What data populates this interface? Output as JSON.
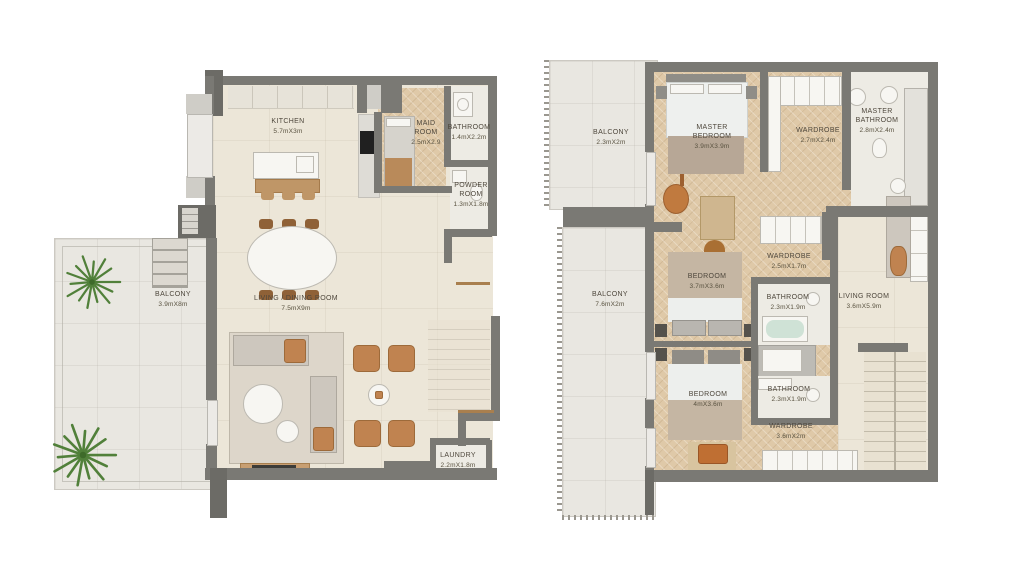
{
  "lower_plan": {
    "rooms": {
      "kitchen": {
        "name": "KITCHEN",
        "dims": "5.7mX3m"
      },
      "maid_room": {
        "name": "MAID ROOM",
        "dims": "2.5mX2.9"
      },
      "bathroom": {
        "name": "BATHROOM",
        "dims": "1.4mX2.2m"
      },
      "powder_room": {
        "name": "POWDER ROOM",
        "dims": "1.3mX1.8m"
      },
      "balcony": {
        "name": "BALCONY",
        "dims": "3.9mX8m"
      },
      "living_dining_room": {
        "name": "LIVING / DINING ROOM",
        "dims": "7.5mX9m"
      },
      "laundry": {
        "name": "LAUNDRY",
        "dims": "2.2mX1.8m"
      }
    }
  },
  "upper_plan": {
    "rooms": {
      "balcony_top": {
        "name": "BALCONY",
        "dims": "2.3mX2m"
      },
      "master_bedroom": {
        "name": "MASTER BEDROOM",
        "dims": "3.9mX3.9m"
      },
      "wardrobe_master": {
        "name": "WARDROBE",
        "dims": "2.7mX2.4m"
      },
      "master_bathroom": {
        "name": "MASTER BATHROOM",
        "dims": "2.8mX2.4m"
      },
      "balcony_side": {
        "name": "BALCONY",
        "dims": "7.6mX2m"
      },
      "bedroom_1": {
        "name": "BEDROOM",
        "dims": "3.7mX3.6m"
      },
      "wardrobe_mid": {
        "name": "WARDROBE",
        "dims": "2.5mX1.7m"
      },
      "bathroom_1": {
        "name": "BATHROOM",
        "dims": "2.3mX1.9m"
      },
      "living_room": {
        "name": "LIVING ROOM",
        "dims": "3.6mX5.9m"
      },
      "bedroom_2": {
        "name": "BEDROOM",
        "dims": "4mX3.6m"
      },
      "bathroom_2": {
        "name": "BATHROOM",
        "dims": "2.3mX1.9m"
      },
      "wardrobe_bottom": {
        "name": "WARDROBE",
        "dims": "3.6mX2m"
      }
    }
  },
  "colors": {
    "wall": "#7a7974",
    "floor_cream": "#ece6d8",
    "floor_wood": "#dfc9a8",
    "balcony_floor": "#e9e7e1",
    "accent_wood": "#c08350",
    "plant_green": "#51803a",
    "label_text": "#4e473c"
  }
}
